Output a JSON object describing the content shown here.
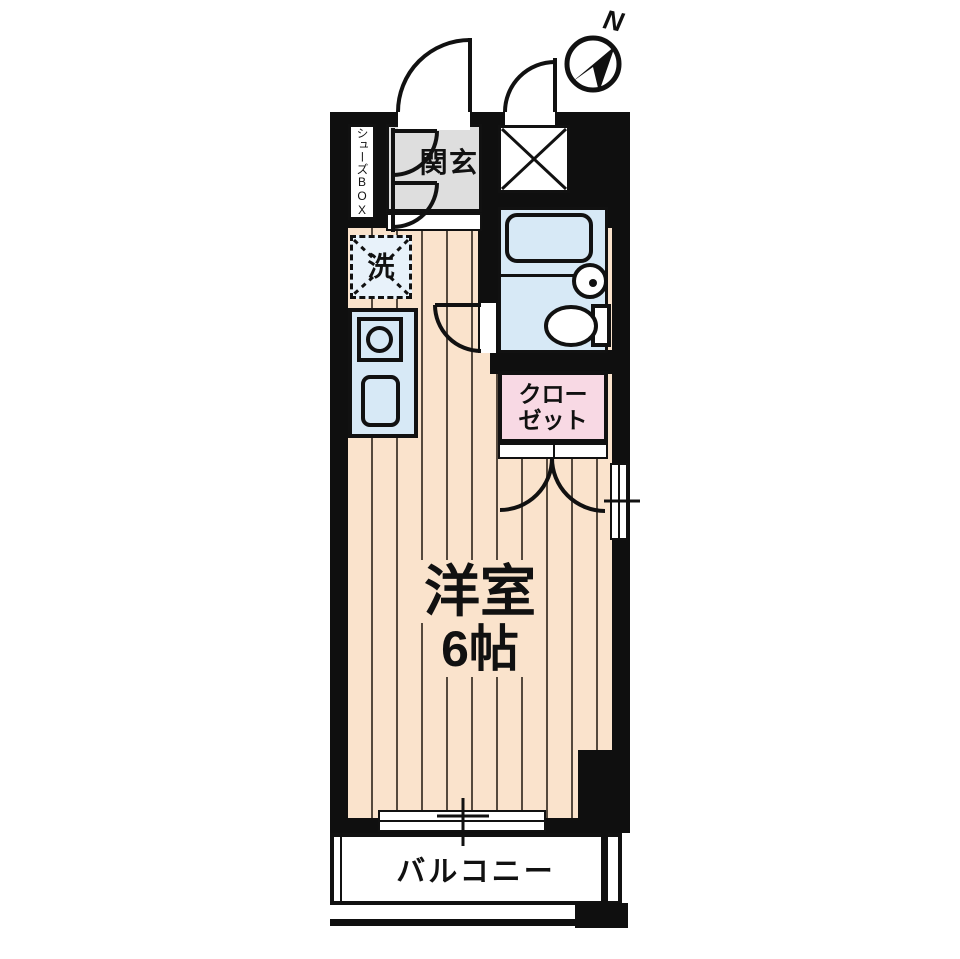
{
  "compass": {
    "label": "N"
  },
  "rooms": {
    "shoes_box": "シューズBOX",
    "genkan": "玄関",
    "laundry": "洗",
    "closet_line1": "クロー",
    "closet_line2": "ゼット",
    "main_room_name": "洋室",
    "main_room_size": "6帖",
    "balcony": "バルコニー"
  },
  "colors": {
    "wall": "#0f0f0f",
    "floor": "#fae3cc",
    "stripe": "#55493d",
    "water": "#d7e9f6",
    "laundry": "#e8f2fa",
    "pink": "#f8d9e4",
    "gray": "#dedede"
  }
}
